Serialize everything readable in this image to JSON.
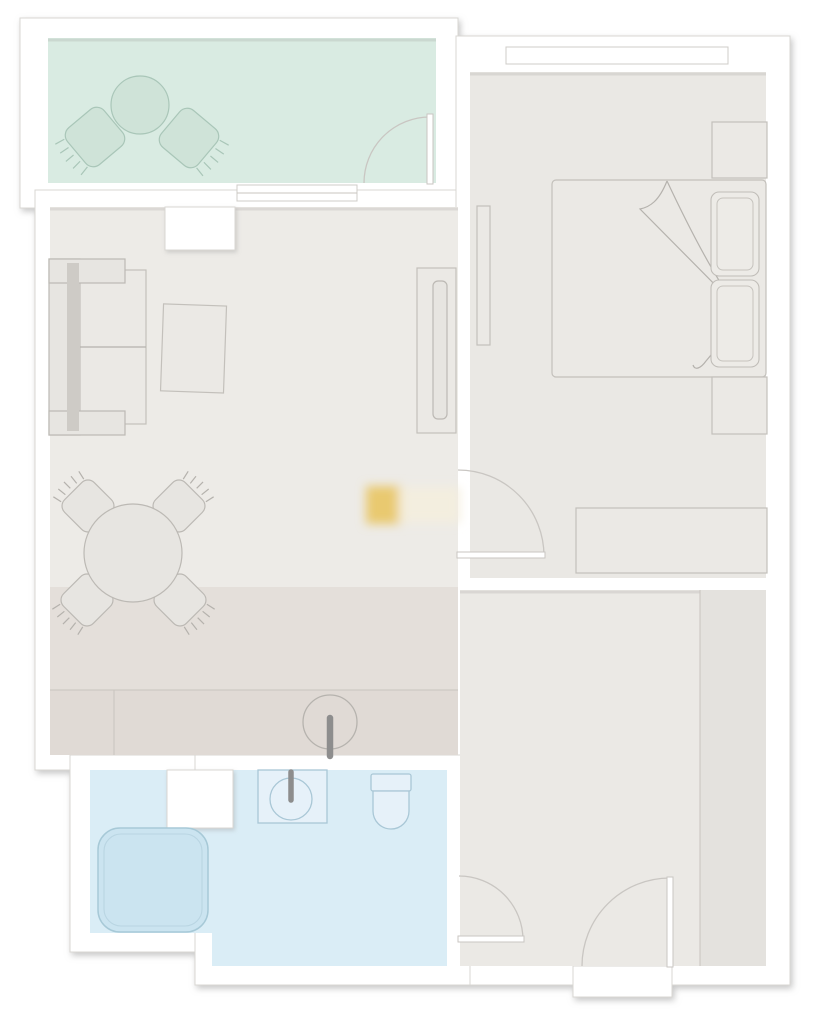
{
  "meta": {
    "type": "floor-plan",
    "description": "top-down apartment floor plan, no visible text labels"
  },
  "colors": {
    "background": "#ffffff",
    "wall_fill": "#ffffff",
    "wall_outline": "#d9d7d3",
    "balcony_floor": "#d9ebe2",
    "balcony_furniture_fill": "#cfe3d8",
    "balcony_furniture_stroke": "#a9c6b8",
    "living_floor": "#edebe7",
    "dining_floor": "#e4dfda",
    "counter_floor": "#e0dad5",
    "bedroom_floor": "#eae8e4",
    "hallway_floor": "#ebe9e5",
    "closet_floor": "#e4e2de",
    "bathroom_floor": "#daedf6",
    "shower_fill": "#cbe4f0",
    "bath_fixture_fill": "#e6f1f9",
    "bath_fixture_stroke": "#a9c7d6",
    "furniture_fill": "#e7e5e1",
    "furniture_stroke": "#bcb9b4",
    "faucet_gray": "#8d8d8d",
    "door_arc": "#c9c6c2",
    "watermark_gold": "#e9c96f"
  },
  "rooms": {
    "balcony": {
      "furniture": [
        "round-table",
        "chair",
        "chair"
      ],
      "doors": [
        "door-to-living-room"
      ]
    },
    "living_dining": {
      "furniture": [
        "sofa",
        "coffee-table",
        "tv-cabinet",
        "tv",
        "dining-table",
        "chair",
        "chair",
        "chair",
        "chair",
        "kitchen-counter",
        "kitchen-sink"
      ],
      "windows": [
        "window-to-balcony"
      ]
    },
    "bedroom": {
      "furniture": [
        "double-bed",
        "pillow",
        "pillow",
        "nightstand",
        "nightstand",
        "dresser",
        "radiator"
      ],
      "windows": [
        "window-top"
      ],
      "doors": [
        "door-to-living-room"
      ]
    },
    "hallway": {
      "furniture": [
        "closet"
      ],
      "doors": [
        "entrance-door",
        "door-to-bathroom"
      ]
    },
    "bathroom": {
      "furniture": [
        "shower",
        "washbasin",
        "toilet"
      ]
    }
  },
  "watermark": {
    "present": true,
    "style": "blurred golden smudge on living room floor"
  }
}
